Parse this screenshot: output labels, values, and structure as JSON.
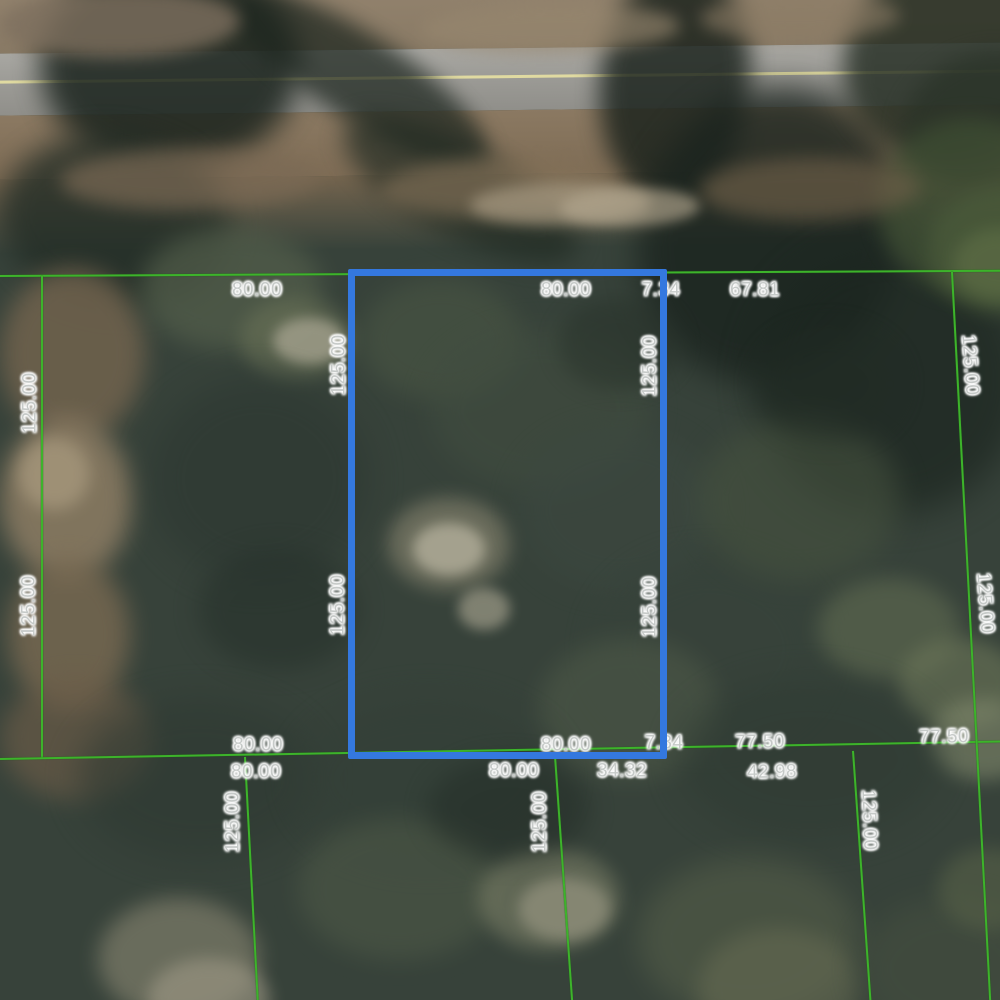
{
  "map": {
    "description": "Aerial parcel map with surveyed lot dimension labels and one highlighted lot",
    "colors": {
      "parcel_line": "#3DB32B",
      "highlight": "#3478DF",
      "road_centerline": "#E8E1A2",
      "label_text": "#C6CAC8"
    },
    "highlighted_parcel": {
      "frontage_label": "80.00",
      "depth_label": "125.00"
    },
    "dimension_labels": [
      {
        "text": "80.00",
        "x": 257,
        "y": 290,
        "rot": 0
      },
      {
        "text": "80.00",
        "x": 566,
        "y": 290,
        "rot": 0
      },
      {
        "text": "7.34",
        "x": 661,
        "y": 290,
        "rot": 0
      },
      {
        "text": "67.81",
        "x": 755,
        "y": 290,
        "rot": 0
      },
      {
        "text": "125.00",
        "x": 30,
        "y": 403,
        "rot": -90
      },
      {
        "text": "125.00",
        "x": 29,
        "y": 606,
        "rot": -90
      },
      {
        "text": "125.00",
        "x": 339,
        "y": 365,
        "rot": -90
      },
      {
        "text": "125.00",
        "x": 338,
        "y": 605,
        "rot": -90
      },
      {
        "text": "125.00",
        "x": 650,
        "y": 366,
        "rot": -90
      },
      {
        "text": "125.00",
        "x": 650,
        "y": 607,
        "rot": -90
      },
      {
        "text": "125.00",
        "x": 970,
        "y": 365,
        "rot": 86
      },
      {
        "text": "125.00",
        "x": 985,
        "y": 603,
        "rot": 86
      },
      {
        "text": "80.00",
        "x": 258,
        "y": 745,
        "rot": 0
      },
      {
        "text": "80.00",
        "x": 566,
        "y": 745,
        "rot": 0
      },
      {
        "text": "7.34",
        "x": 664,
        "y": 743,
        "rot": 0
      },
      {
        "text": "77.50",
        "x": 760,
        "y": 742,
        "rot": -1
      },
      {
        "text": "77.50",
        "x": 944,
        "y": 737,
        "rot": -1
      },
      {
        "text": "80.00",
        "x": 256,
        "y": 772,
        "rot": 0
      },
      {
        "text": "80.00",
        "x": 514,
        "y": 771,
        "rot": 0
      },
      {
        "text": "34.32",
        "x": 622,
        "y": 771,
        "rot": 0
      },
      {
        "text": "42.98",
        "x": 772,
        "y": 772,
        "rot": -1
      },
      {
        "text": "125.00",
        "x": 233,
        "y": 822,
        "rot": -90
      },
      {
        "text": "125.00",
        "x": 540,
        "y": 822,
        "rot": -90
      },
      {
        "text": "125.00",
        "x": 869,
        "y": 820,
        "rot": 88
      }
    ]
  }
}
